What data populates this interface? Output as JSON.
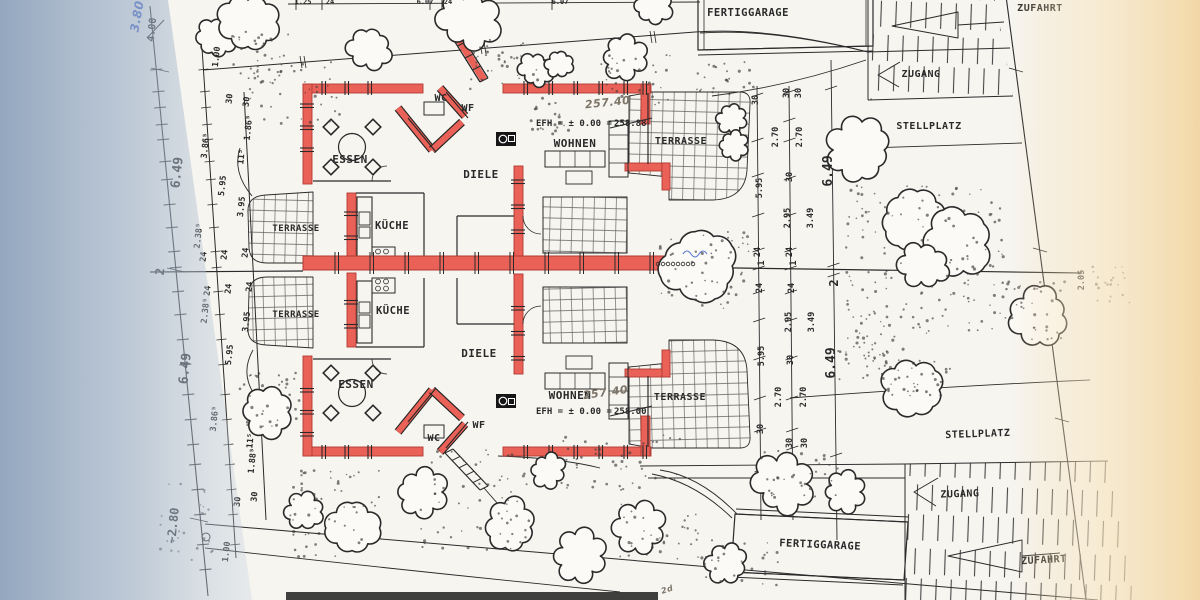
{
  "colors": {
    "wall_red": "#ea6157",
    "wall_red_edge": "#b23a33",
    "ink": "#2a2a2a",
    "blue_pen": "#3a5fc8",
    "pencil": "#7d7468",
    "shadow_blue": "#9fb1c8",
    "paper": "#f6f5f0",
    "warm_edge": "#f4d9a8"
  },
  "upper_unit": {
    "essen": "ESSEN",
    "wc": "WC",
    "wf": "WF",
    "diele": "DIELE",
    "kueche": "KÜCHE",
    "wohnen": "WOHNEN",
    "terrasse_left": "TERRASSE",
    "terrasse_right": "TERRASSE",
    "efh_prefix": "EFH = ± 0.00 =",
    "efh_old": "258.88",
    "efh_handwritten": "257.40"
  },
  "lower_unit": {
    "essen": "ESSEN",
    "wc": "WC",
    "wf": "WF",
    "diele": "DIELE",
    "kueche": "KÜCHE",
    "wohnen": "WOHNEN",
    "terrasse_left": "TERRASSE",
    "terrasse_right": "TERRASSE",
    "efh_prefix": "EFH = ± 0.00 =",
    "efh_old": "258.00",
    "efh_handwritten": "257.40"
  },
  "site": {
    "fertiggarage_top": "FERTIGGARAGE",
    "fertiggarage_bottom": "FERTIGGARAGE",
    "zufahrt_top": "ZUFAHRT",
    "zufahrt_bottom": "ZUFAHRT",
    "zugang_top": "ZUGANG",
    "zugang_bottom": "ZUGANG",
    "stellplatz_top": "STELLPLATZ",
    "stellplatz_bottom": "STELLPLATZ"
  },
  "handwritten": {
    "corner_new": "3.80",
    "corner_old": "4.00",
    "note_bottom": "2d"
  },
  "dim_labels_left": [
    {
      "t": "1.00",
      "x": 219,
      "y": 57
    },
    {
      "t": "30",
      "x": 232,
      "y": 99
    },
    {
      "t": "30",
      "x": 249,
      "y": 102
    },
    {
      "t": "1.86⁵",
      "x": 251,
      "y": 128
    },
    {
      "t": "3.86⁵",
      "x": 208,
      "y": 146
    },
    {
      "t": "11⁵",
      "x": 244,
      "y": 157
    },
    {
      "t": "5.95",
      "x": 225,
      "y": 186
    },
    {
      "t": "6.49",
      "x": 181,
      "y": 173,
      "fs": 13
    },
    {
      "t": "3.95",
      "x": 244,
      "y": 207
    },
    {
      "t": "2.38⁵",
      "x": 201,
      "y": 236
    },
    {
      "t": "24",
      "x": 206,
      "y": 257
    },
    {
      "t": "24",
      "x": 227,
      "y": 255
    },
    {
      "t": "24",
      "x": 248,
      "y": 253
    },
    {
      "t": "2",
      "x": 164,
      "y": 272,
      "fs": 12
    },
    {
      "t": "24",
      "x": 210,
      "y": 291
    },
    {
      "t": "24",
      "x": 231,
      "y": 289
    },
    {
      "t": "24",
      "x": 252,
      "y": 287
    },
    {
      "t": "2.38⁵",
      "x": 208,
      "y": 311
    },
    {
      "t": "3.95",
      "x": 249,
      "y": 322
    },
    {
      "t": "5.95",
      "x": 232,
      "y": 355
    },
    {
      "t": "6.49",
      "x": 189,
      "y": 369,
      "fs": 13
    },
    {
      "t": "3.86⁵",
      "x": 217,
      "y": 419
    },
    {
      "t": "11⁵",
      "x": 253,
      "y": 441
    },
    {
      "t": "1.88⁵",
      "x": 255,
      "y": 461
    },
    {
      "t": "30",
      "x": 240,
      "y": 502
    },
    {
      "t": "30",
      "x": 257,
      "y": 497
    },
    {
      "t": "1.00",
      "x": 229,
      "y": 552
    },
    {
      "t": "~2.80",
      "x": 177,
      "y": 526,
      "fs": 12
    }
  ],
  "dim_labels_middle": [
    {
      "t": "30",
      "x": 758,
      "y": 100
    },
    {
      "t": "30",
      "x": 789,
      "y": 93
    },
    {
      "t": "30",
      "x": 801,
      "y": 93
    },
    {
      "t": "2.70",
      "x": 778,
      "y": 137
    },
    {
      "t": "2.70",
      "x": 802,
      "y": 137
    },
    {
      "t": "5.95",
      "x": 762,
      "y": 188
    },
    {
      "t": "30",
      "x": 792,
      "y": 177
    },
    {
      "t": "6.49",
      "x": 832,
      "y": 171,
      "fs": 13
    },
    {
      "t": "2.95",
      "x": 790,
      "y": 218
    },
    {
      "t": "3.49",
      "x": 813,
      "y": 218
    },
    {
      "t": "24",
      "x": 760,
      "y": 252
    },
    {
      "t": "24",
      "x": 792,
      "y": 252
    },
    {
      "t": "1",
      "x": 764,
      "y": 263
    },
    {
      "t": "1",
      "x": 796,
      "y": 263
    },
    {
      "t": "2",
      "x": 838,
      "y": 283,
      "fs": 12
    },
    {
      "t": "24",
      "x": 762,
      "y": 288
    },
    {
      "t": "24",
      "x": 794,
      "y": 288
    },
    {
      "t": "2.95",
      "x": 791,
      "y": 322
    },
    {
      "t": "3.49",
      "x": 814,
      "y": 322
    },
    {
      "t": "5.95",
      "x": 764,
      "y": 356
    },
    {
      "t": "30",
      "x": 793,
      "y": 360
    },
    {
      "t": "6.49",
      "x": 835,
      "y": 363,
      "fs": 13
    },
    {
      "t": "2.70",
      "x": 781,
      "y": 397
    },
    {
      "t": "2.70",
      "x": 806,
      "y": 397
    },
    {
      "t": "30",
      "x": 763,
      "y": 429
    },
    {
      "t": "30",
      "x": 792,
      "y": 443
    },
    {
      "t": "30",
      "x": 807,
      "y": 443
    }
  ],
  "dim_labels_top": [
    {
      "t": "1.25",
      "x": 303
    },
    {
      "t": "24",
      "x": 330
    },
    {
      "t": "6.07",
      "x": 425
    },
    {
      "t": "24",
      "x": 448
    },
    {
      "t": "6.07",
      "x": 560
    }
  ],
  "right_edge_label": {
    "t": "2.05",
    "x": 1084,
    "y": 280
  }
}
